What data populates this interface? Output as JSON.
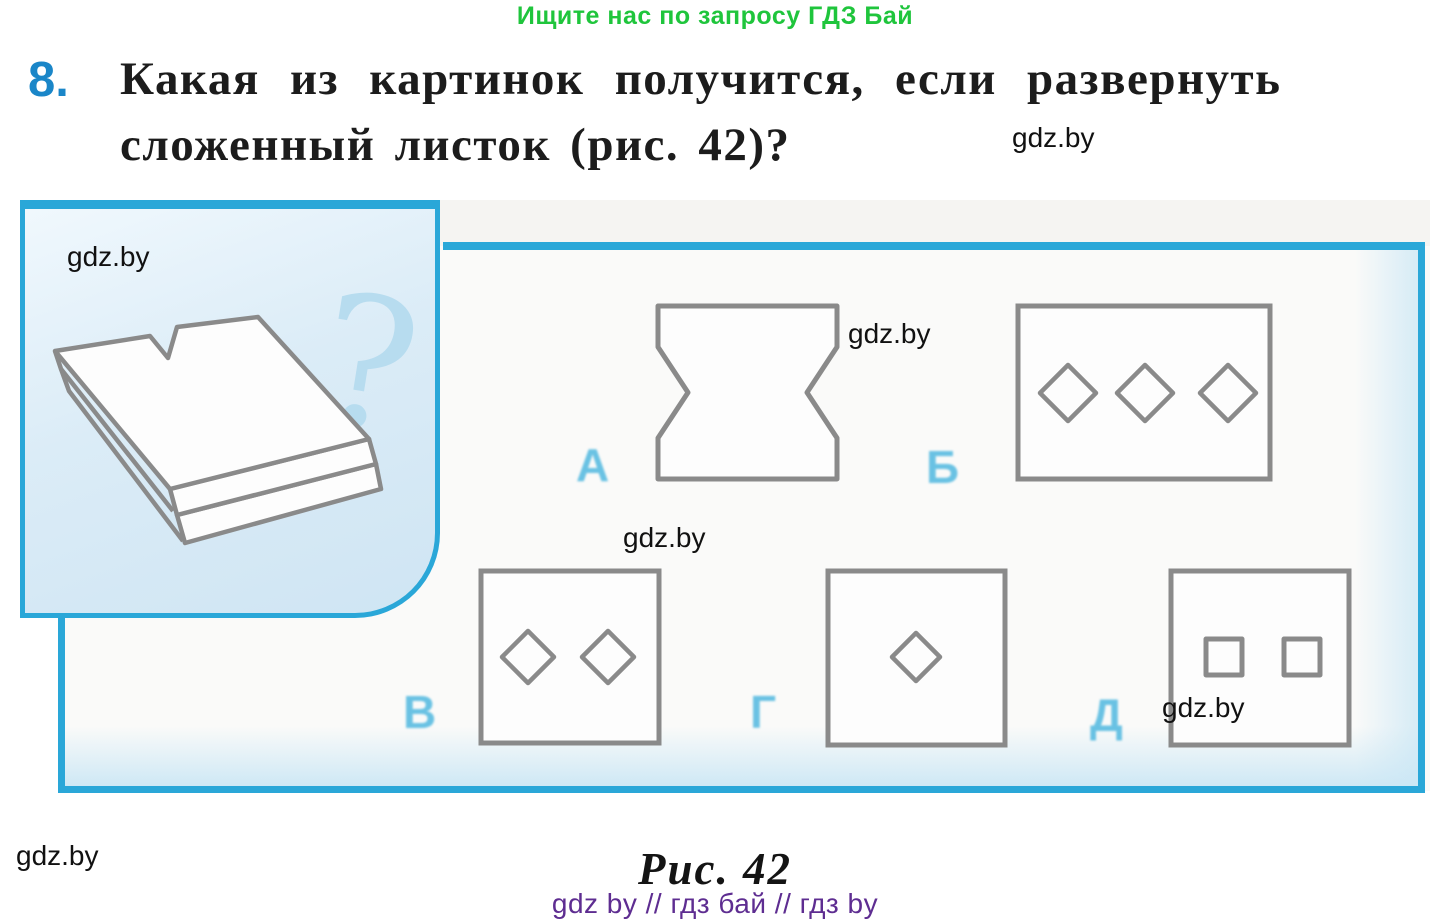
{
  "header": {
    "promo": "Ищите нас по запросу ГДЗ Бай",
    "task_number": "8.",
    "question_line1": "Какая из картинок получится, если развернуть",
    "question_line2": "сложенный листок (рис. 42)?"
  },
  "watermark": {
    "text": "gdz.by"
  },
  "figure": {
    "question_mark": "?",
    "prompt_illustration": "folded-paper-with-notch",
    "options": [
      {
        "label": "А",
        "shape": "square-with-side-notches"
      },
      {
        "label": "Б",
        "shape": "rectangle-with-three-diamonds"
      },
      {
        "label": "В",
        "shape": "square-with-two-diamonds"
      },
      {
        "label": "Г",
        "shape": "square-with-one-diamond"
      },
      {
        "label": "Д",
        "shape": "square-with-two-small-squares"
      }
    ]
  },
  "caption": {
    "figure_label": "Рис. 42",
    "footer_links": "gdz by  //  гдз бай  //  гдз by"
  },
  "colors": {
    "frame_blue": "#2aa7d8",
    "number_blue": "#1a86c8",
    "promo_green": "#1fc53c",
    "footer_purple": "#5e2d91",
    "option_letter_blue": "#45b4de",
    "shape_stroke_gray": "#8a8a8a"
  }
}
